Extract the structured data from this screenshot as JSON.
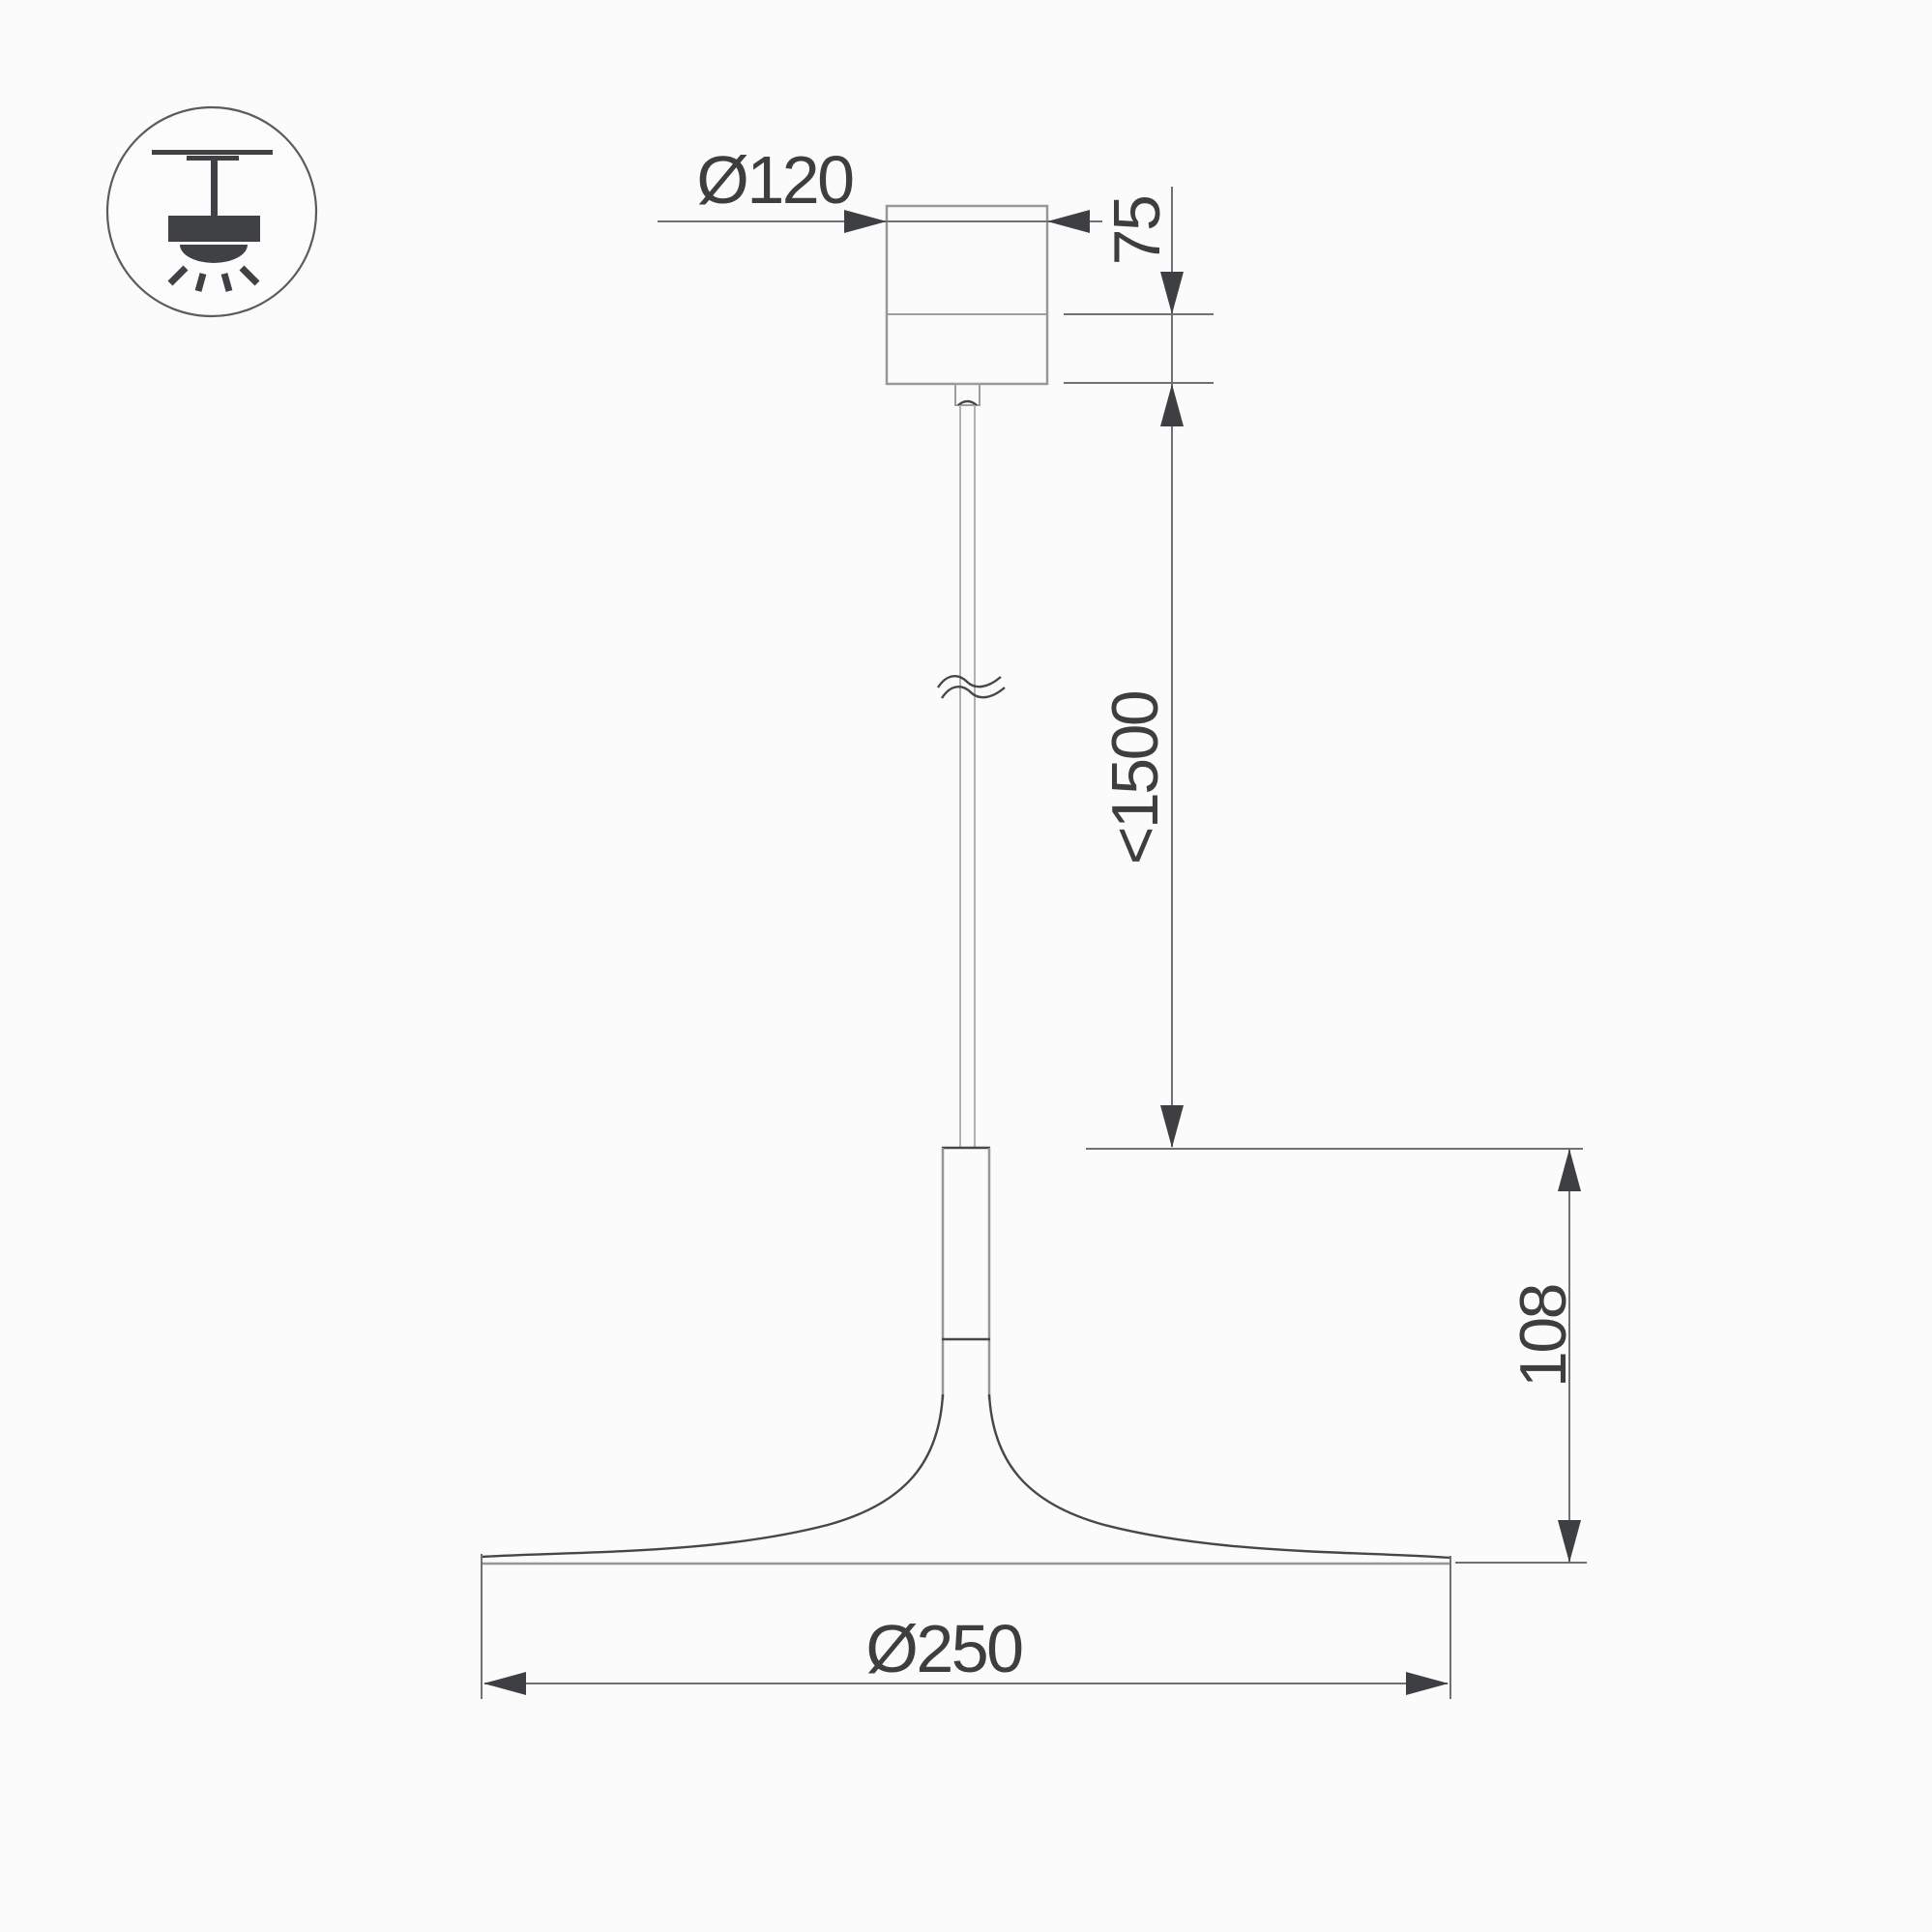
{
  "drawing": {
    "title": "pendant-luminaire-dimension-drawing",
    "type_badge_icon": "pendant-lamp-icon",
    "dimensions": {
      "canopy_diameter": {
        "label": "Ø120",
        "meaning": "ceiling canopy diameter, mm"
      },
      "canopy_height": {
        "label": "75",
        "meaning": "canopy visible height, mm"
      },
      "suspension_length": {
        "label": "<1500",
        "meaning": "max suspension wire length, mm"
      },
      "shade_height": {
        "label": "108",
        "meaning": "lamp head height, mm"
      },
      "shade_diameter": {
        "label": "Ø250",
        "meaning": "shade diameter, mm"
      }
    },
    "colors": {
      "background": "#fbfbfb",
      "body_outline_gray": "#95979a",
      "cable_gray": "#b0b2b4",
      "detail_dark": "#45474a",
      "dimension_line": "#6f7174",
      "arrow_fill": "#3d3f42",
      "text": "#3d3e40",
      "icon": "#3f4145"
    }
  }
}
